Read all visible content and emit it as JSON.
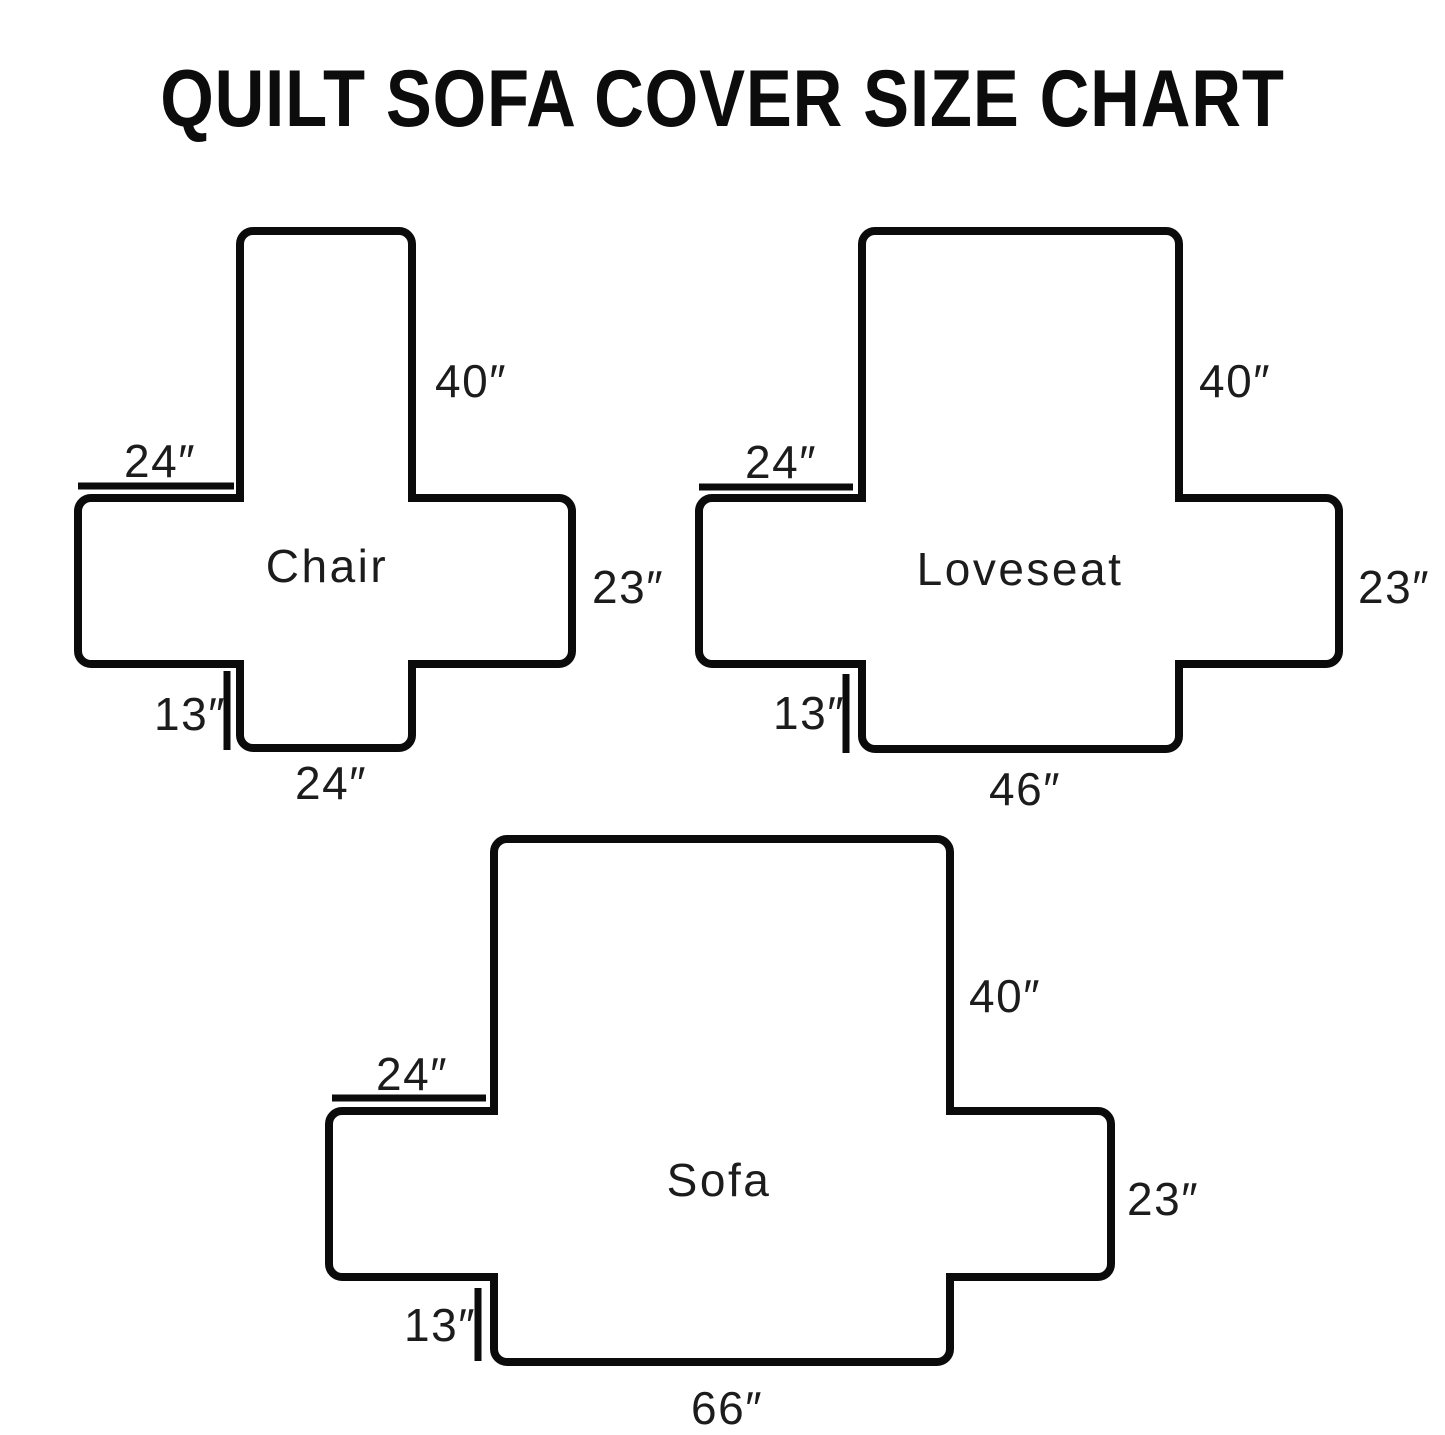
{
  "title": "QUILT SOFA COVER SIZE CHART",
  "ink_color": "#0b0b0b",
  "diagrams": [
    {
      "name": "Chair",
      "dims": {
        "back_height": "40″",
        "arm_width": "24″",
        "side_depth": "23″",
        "front_skirt": "13″",
        "seat_width": "24″"
      }
    },
    {
      "name": "Loveseat",
      "dims": {
        "back_height": "40″",
        "arm_width": "24″",
        "side_depth": "23″",
        "front_skirt": "13″",
        "seat_width": "46″"
      }
    },
    {
      "name": "Sofa",
      "dims": {
        "back_height": "40″",
        "arm_width": "24″",
        "side_depth": "23″",
        "front_skirt": "13″",
        "seat_width": "66″"
      }
    }
  ]
}
